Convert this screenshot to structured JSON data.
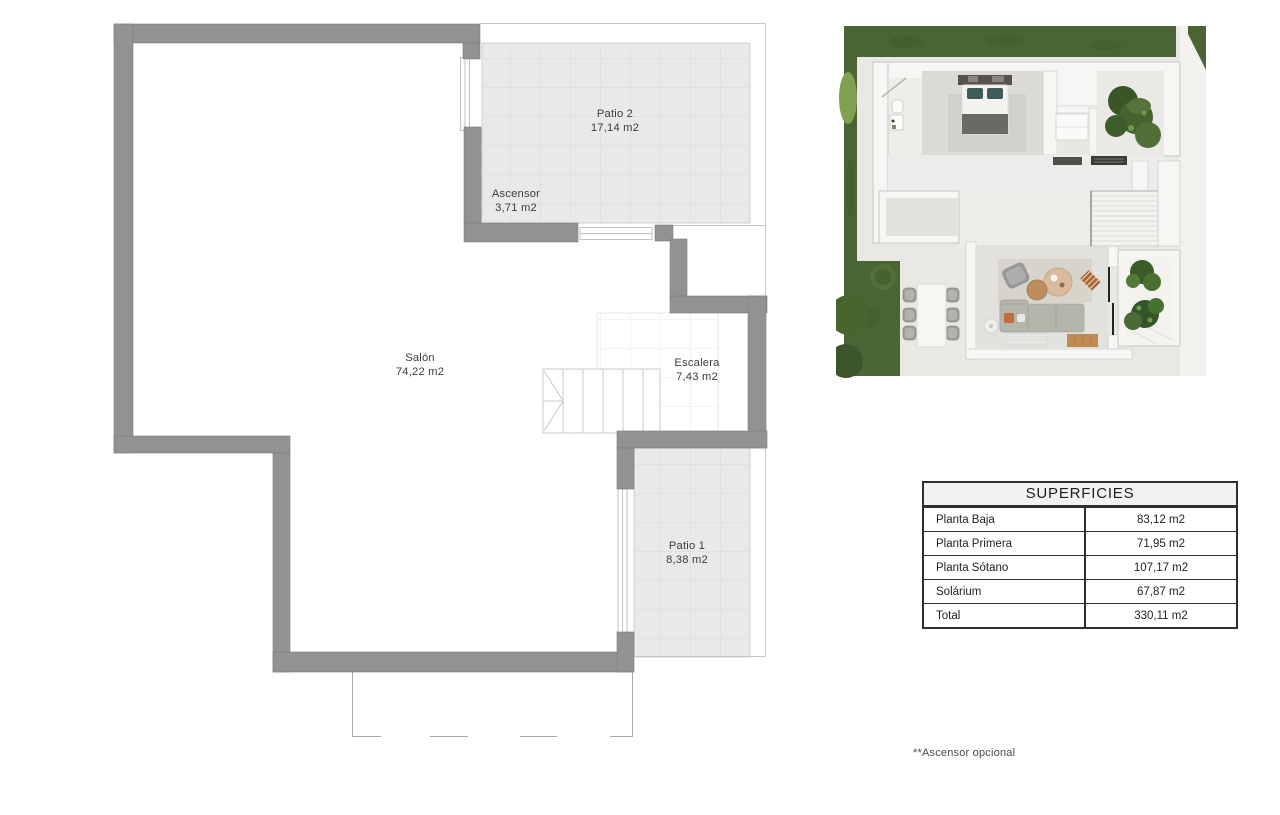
{
  "plan": {
    "rooms": [
      {
        "id": "patio2",
        "name": "Patio 2",
        "area": "17,14 m2"
      },
      {
        "id": "ascensor",
        "name": "Ascensor",
        "area": "3,71 m2"
      },
      {
        "id": "salon",
        "name": "Salón",
        "area": "74,22 m2"
      },
      {
        "id": "escalera",
        "name": "Escalera",
        "area": "7,43 m2"
      },
      {
        "id": "patio1",
        "name": "Patio 1",
        "area": "8,38 m2"
      }
    ],
    "colors": {
      "wall": "#929292",
      "tile": "#e9e9e9",
      "thin_line": "#c6c6c6",
      "text": "#3c3c3c"
    }
  },
  "table": {
    "title": "SUPERFICIES",
    "rows": [
      {
        "label": "Planta Baja",
        "value": "83,12 m2"
      },
      {
        "label": "Planta Primera",
        "value": "71,95 m2"
      },
      {
        "label": "Planta Sótano",
        "value": "107,17 m2"
      },
      {
        "label": "Solárium",
        "value": "67,87 m2"
      },
      {
        "label": "Total",
        "value": "330,11 m2"
      }
    ],
    "border_color": "#2e2e2e",
    "header_bg": "#f2f2f2"
  },
  "footnote": "**Ascensor opcional",
  "render": {
    "grass_color": "#4a6434",
    "terrace_color": "#e9e8e5",
    "wall_color": "#f7f6f4"
  }
}
